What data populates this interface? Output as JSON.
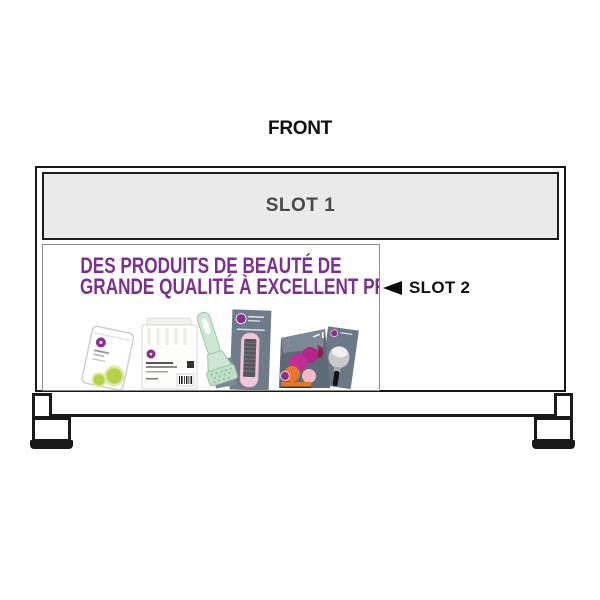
{
  "page": {
    "title": "FRONT"
  },
  "fixture": {
    "slot1": {
      "label": "SLOT 1"
    },
    "slot2": {
      "label": "SLOT 2"
    }
  },
  "ad_panel": {
    "headline_line1": "DES PRODUITS DE BEAUTÉ DE",
    "headline_line2": "GRANDE QUALITÉ À EXCELLENT PRIX"
  },
  "product_icons": [
    "white-sachet-pouch",
    "cotton-pads-pack",
    "mint-green-brush-tool",
    "pink-foot-file-card",
    "makeup-sponges-pouch",
    "makeup-brush-card"
  ],
  "colors": {
    "headline_purple": "#7b2f8f",
    "brand_purple": "#8e2f8e",
    "slot1_bg": "#eaeaea",
    "slot1_text": "#4a4a4a",
    "outline_black": "#1a1a1a",
    "slate_gray": "#66737f",
    "mint_green": "#cde7d2",
    "pink": "#f0c6d8",
    "lime_green": "#b5d24a",
    "magenta": "#c22e93",
    "orange": "#e87722"
  }
}
